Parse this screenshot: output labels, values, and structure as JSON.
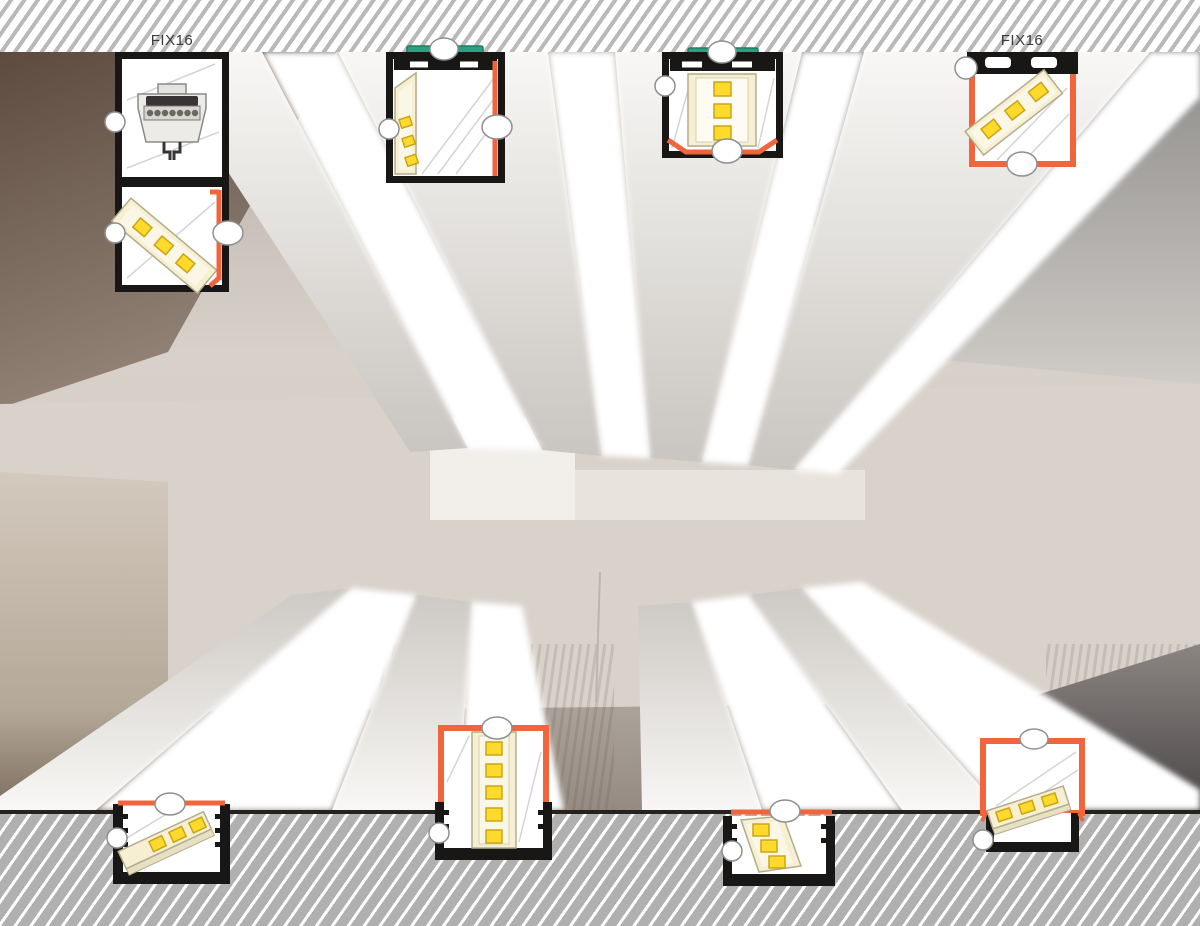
{
  "illustration": {
    "type": "led-aluminium-profile-mounting-illustration",
    "scene": "ceiling photographed from below with radiating linear LED luminaires",
    "labels": {
      "fix16_left": "FIX16",
      "fix16_right": "FIX16"
    }
  },
  "colors": {
    "accent-orange": "#f0653c",
    "clip-green": "#2aa183",
    "led-yellow": "#ffd92b",
    "led-chip-border": "#c9a516",
    "led-board": "#f6efd2",
    "led-board-border": "#b3ac8c",
    "profile-black": "#181715",
    "callout-border": "#8f8f8f",
    "hatch-top-stripe": "#b9b9b9",
    "hatch-bottom-bg": "#b0b0b0",
    "label-text": "#3b3b3b"
  },
  "diagrams": [
    {
      "id": "d1",
      "name": "surface-profile-with-connector",
      "label": "FIX16",
      "markers": 3
    },
    {
      "id": "d2",
      "name": "suspended-profile-side-led",
      "markers": 3
    },
    {
      "id": "d3",
      "name": "suspended-profile-front-led",
      "markers": 3
    },
    {
      "id": "d4",
      "name": "surface-profile-diagonal-led",
      "label": "FIX16",
      "markers": 2
    },
    {
      "id": "d5",
      "name": "recessed-profile-flat-led",
      "markers": 2
    },
    {
      "id": "d6",
      "name": "recessed-deep-profile-vertical-led",
      "markers": 2
    },
    {
      "id": "d7",
      "name": "recessed-profile-flat-led",
      "markers": 2
    },
    {
      "id": "d8",
      "name": "recessed-profile-orange-channel",
      "markers": 2
    }
  ]
}
